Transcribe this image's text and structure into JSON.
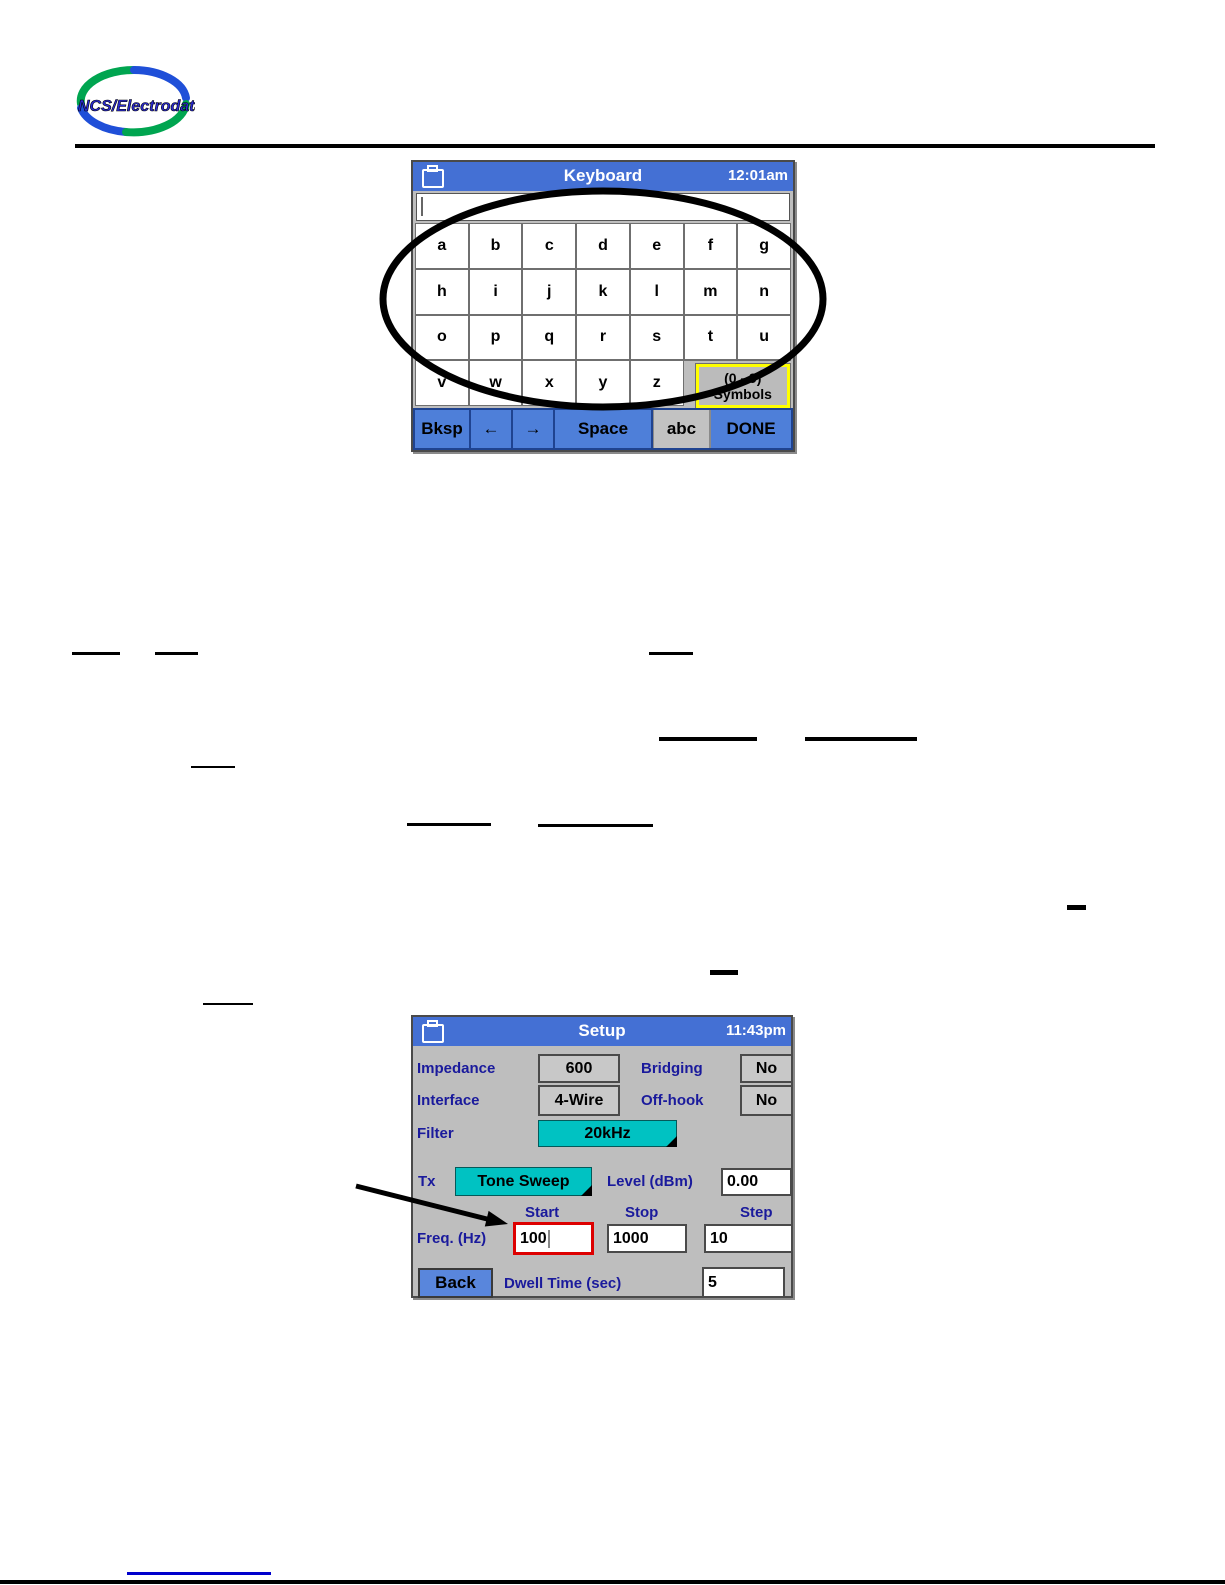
{
  "logo": {
    "text": "NCS/Electrodata"
  },
  "keyboard_screen": {
    "title": "Keyboard",
    "time": "12:01am",
    "input_value": "",
    "rows": [
      [
        "a",
        "b",
        "c",
        "d",
        "e",
        "f",
        "g"
      ],
      [
        "h",
        "i",
        "j",
        "k",
        "l",
        "m",
        "n"
      ],
      [
        "o",
        "p",
        "q",
        "r",
        "s",
        "t",
        "u"
      ],
      [
        "v",
        "w",
        "x",
        "y",
        "z"
      ]
    ],
    "symbols_key": {
      "line1": "(0 - 9)",
      "line2": "Symbols"
    },
    "bottom_buttons": [
      {
        "label": "Bksp",
        "name": "bksp",
        "style": "blue"
      },
      {
        "label": "←",
        "name": "arrow-left",
        "style": "blue"
      },
      {
        "label": "→",
        "name": "arrow-right",
        "style": "blue"
      },
      {
        "label": "Space",
        "name": "space",
        "style": "blue"
      },
      {
        "label": "abc",
        "name": "abc",
        "style": "gray"
      },
      {
        "label": "DONE",
        "name": "done",
        "style": "blue"
      }
    ]
  },
  "setup_screen": {
    "title": "Setup",
    "time": "11:43pm",
    "impedance_label": "Impedance",
    "impedance_value": "600",
    "bridging_label": "Bridging",
    "bridging_value": "No",
    "interface_label": "Interface",
    "interface_value": "4-Wire",
    "offhook_label": "Off-hook",
    "offhook_value": "No",
    "filter_label": "Filter",
    "filter_value": "20kHz",
    "tx_label": "Tx",
    "tx_value": "Tone Sweep",
    "level_label": "Level (dBm)",
    "level_value": "0.00",
    "start_label": "Start",
    "stop_label": "Stop",
    "step_label": "Step",
    "freq_label": "Freq. (Hz)",
    "freq_start_value": "100",
    "freq_stop_value": "1000",
    "freq_step_value": "10",
    "back_label": "Back",
    "dwell_label": "Dwell Time (sec)",
    "dwell_value": "5"
  },
  "colors": {
    "titlebar_blue": "#4470D4",
    "button_blue": "#4E7FD9",
    "back_blue": "#5986DC",
    "teal": "#00C2C2",
    "screen_gray": "#BEBEBE",
    "label_navy": "#1A1A9C",
    "highlight_red": "#DD0000",
    "symbols_yellow": "#FFFF00",
    "link_blue": "#0000CC"
  },
  "annotations": {
    "underlines": [
      {
        "x": 72,
        "y": 652,
        "w": 48,
        "h": 3
      },
      {
        "x": 155,
        "y": 652,
        "w": 43,
        "h": 3
      },
      {
        "x": 649,
        "y": 652,
        "w": 44,
        "h": 3
      },
      {
        "x": 659,
        "y": 737,
        "w": 98,
        "h": 4
      },
      {
        "x": 805,
        "y": 737,
        "w": 112,
        "h": 4
      },
      {
        "x": 191,
        "y": 766,
        "w": 44,
        "h": 2
      },
      {
        "x": 407,
        "y": 823,
        "w": 84,
        "h": 3
      },
      {
        "x": 538,
        "y": 824,
        "w": 115,
        "h": 3
      },
      {
        "x": 1067,
        "y": 905,
        "w": 19,
        "h": 5
      },
      {
        "x": 710,
        "y": 970,
        "w": 28,
        "h": 5
      },
      {
        "x": 203,
        "y": 1003,
        "w": 50,
        "h": 2
      },
      {
        "x": 127,
        "y": 1572,
        "w": 144,
        "h": 3,
        "color": "#0000CC"
      }
    ]
  }
}
